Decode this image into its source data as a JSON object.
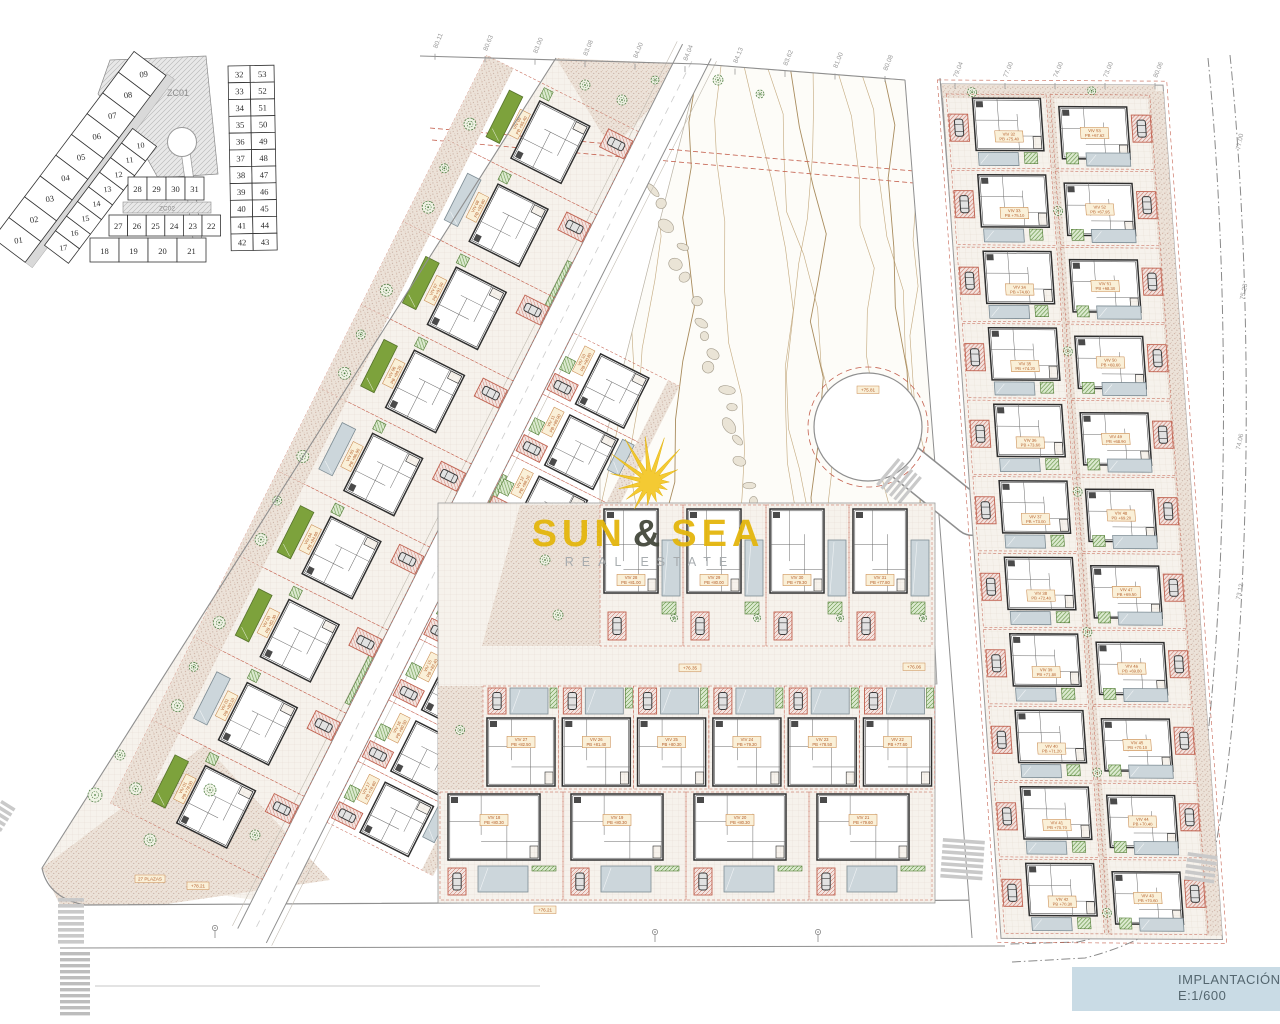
{
  "title_block": {
    "line1": "IMPLANTACIÓN PB",
    "line2": "E:1/600"
  },
  "logo": {
    "word1": "SUN",
    "ampersand": "&",
    "word2": "SEA",
    "subtitle": "REAL ESTATE"
  },
  "key_plan": {
    "zone_upper": "ZC01",
    "zone_lower": "ZC02",
    "outer_lots": [
      "09",
      "08",
      "07",
      "06",
      "05",
      "04",
      "03",
      "02",
      "01"
    ],
    "inner_lots": [
      "10",
      "11",
      "12",
      "13",
      "14",
      "15",
      "16",
      "17"
    ],
    "row_upper": [
      "28",
      "29",
      "30",
      "31"
    ],
    "row_mid": [
      "27",
      "26",
      "25",
      "24",
      "23",
      "22"
    ],
    "row_bottom": [
      "18",
      "19",
      "20",
      "21"
    ],
    "right_pairs": [
      [
        "32",
        "53"
      ],
      [
        "33",
        "52"
      ],
      [
        "34",
        "51"
      ],
      [
        "35",
        "50"
      ],
      [
        "36",
        "49"
      ],
      [
        "37",
        "48"
      ],
      [
        "38",
        "47"
      ],
      [
        "39",
        "46"
      ],
      [
        "40",
        "45"
      ],
      [
        "41",
        "44"
      ],
      [
        "42",
        "43"
      ]
    ]
  },
  "villas": {
    "left_outer": [
      {
        "id": "VIV 01",
        "pb": "PB +78.00"
      },
      {
        "id": "VIV 02",
        "pb": "PB +80.10"
      },
      {
        "id": "VIV 03",
        "pb": "PB +82.30"
      },
      {
        "id": "VIV 04",
        "pb": "PB +84.60"
      },
      {
        "id": "VIV 05",
        "pb": "PB +86.90"
      },
      {
        "id": "VIV 06",
        "pb": "PB +89.20"
      },
      {
        "id": "VIV 07",
        "pb": "PB +91.50"
      },
      {
        "id": "VIV 08",
        "pb": "PB +93.80"
      },
      {
        "id": "VIV 09",
        "pb": "PB +95.40"
      }
    ],
    "left_inner": [
      {
        "id": "VIV 17",
        "pb": "PB +78.60"
      },
      {
        "id": "VIV 16",
        "pb": "PB +80.50"
      },
      {
        "id": "VIV 15",
        "pb": "PB +82.40"
      },
      {
        "id": "VIV 14",
        "pb": "PB +84.30"
      },
      {
        "id": "VIV 13",
        "pb": "PB +86.20"
      },
      {
        "id": "VIV 12",
        "pb": "PB +88.10"
      },
      {
        "id": "VIV 11",
        "pb": "PB +89.90"
      },
      {
        "id": "VIV 10",
        "pb": "PB +90.80"
      }
    ],
    "center_upper": [
      {
        "id": "VIV 28",
        "pb": "PB +81.00"
      },
      {
        "id": "VIV 29",
        "pb": "PB +80.00"
      },
      {
        "id": "VIV 30",
        "pb": "PB +79.30"
      },
      {
        "id": "VIV 31",
        "pb": "PB +77.80"
      }
    ],
    "center_mid": [
      {
        "id": "VIV 27",
        "pb": "PB +82.50"
      },
      {
        "id": "VIV 26",
        "pb": "PB +81.40"
      },
      {
        "id": "VIV 25",
        "pb": "PB +80.30"
      },
      {
        "id": "VIV 24",
        "pb": "PB +79.20"
      },
      {
        "id": "VIV 23",
        "pb": "PB +78.50"
      },
      {
        "id": "VIV 22",
        "pb": "PB +77.60"
      }
    ],
    "center_bottom": [
      {
        "id": "VIV 18",
        "pb": "PB +80.30"
      },
      {
        "id": "VIV 19",
        "pb": "PB +80.30"
      },
      {
        "id": "VIV 20",
        "pb": "PB +80.30"
      },
      {
        "id": "VIV 21",
        "pb": "PB +79.60"
      }
    ],
    "right_left_col": [
      {
        "id": "VIV 32",
        "pb": "PB +75.40"
      },
      {
        "id": "VIV 33",
        "pb": "PB +75.10"
      },
      {
        "id": "VIV 34",
        "pb": "PB +74.60"
      },
      {
        "id": "VIV 35",
        "pb": "PB +74.20"
      },
      {
        "id": "VIV 36",
        "pb": "PB +73.60"
      },
      {
        "id": "VIV 37",
        "pb": "PB +73.00"
      },
      {
        "id": "VIV 38",
        "pb": "PB +72.40"
      },
      {
        "id": "VIV 39",
        "pb": "PB +71.80"
      },
      {
        "id": "VIV 40",
        "pb": "PB +71.20"
      },
      {
        "id": "VIV 41",
        "pb": "PB +70.70"
      },
      {
        "id": "VIV 42",
        "pb": "PB +70.30"
      }
    ],
    "right_right_col": [
      {
        "id": "VIV 53",
        "pb": "PB +67.62"
      },
      {
        "id": "VIV 52",
        "pb": "PB +67.95"
      },
      {
        "id": "VIV 51",
        "pb": "PB +68.30"
      },
      {
        "id": "VIV 50",
        "pb": "PB +68.60"
      },
      {
        "id": "VIV 49",
        "pb": "PB +68.90"
      },
      {
        "id": "VIV 48",
        "pb": "PB +69.20"
      },
      {
        "id": "VIV 47",
        "pb": "PB +69.50"
      },
      {
        "id": "VIV 46",
        "pb": "PB +69.80"
      },
      {
        "id": "VIV 45",
        "pb": "PB +70.10"
      },
      {
        "id": "VIV 44",
        "pb": "PB +70.40"
      },
      {
        "id": "VIV 43",
        "pb": "PB +70.60"
      }
    ]
  },
  "boundary_marks": [
    "80.11",
    "80.63",
    "83.00",
    "83.08",
    "84.00",
    "84.04",
    "84.13",
    "83.62",
    "81.00",
    "80.08",
    "79.04",
    "77.00",
    "74.00",
    "73.00",
    "80.06"
  ],
  "right_marks": [
    "77.00",
    "75.23",
    "74.06",
    "73.12"
  ],
  "road_labels": [
    {
      "text": "+76.21",
      "x": 545,
      "y": 910
    },
    {
      "text": "+75.81",
      "x": 868,
      "y": 390
    },
    {
      "text": "+76.06",
      "x": 914,
      "y": 667
    },
    {
      "text": "+76.35",
      "x": 690,
      "y": 668
    },
    {
      "text": "+78.21",
      "x": 198,
      "y": 886
    },
    {
      "text": "27 PLAZAS",
      "x": 150,
      "y": 879
    }
  ],
  "colors": {
    "label_bg": "#faf0d8",
    "label_stroke": "#c98a4e",
    "label_text": "#b35c28",
    "pool_green": "#7da23c",
    "pool_green_stroke": "#55722a",
    "pool_gray": "#ccd6db",
    "pool_gray_stroke": "#7d8c94",
    "parking_red": "#c0604e",
    "road_gray": "#d7d6d3",
    "road_edge": "#8f8f8f",
    "contour": "#c6ad84",
    "contour_index": "#a98c5e",
    "boundary_dash_red": "#c4604e",
    "tree_green": "#4d7c41",
    "title_band": "#c9dbe5",
    "title_text": "#54666f",
    "logo_yellow": "#e4b60d",
    "logo_dark": "#44483c",
    "logo_gray": "#a4a9ac"
  }
}
